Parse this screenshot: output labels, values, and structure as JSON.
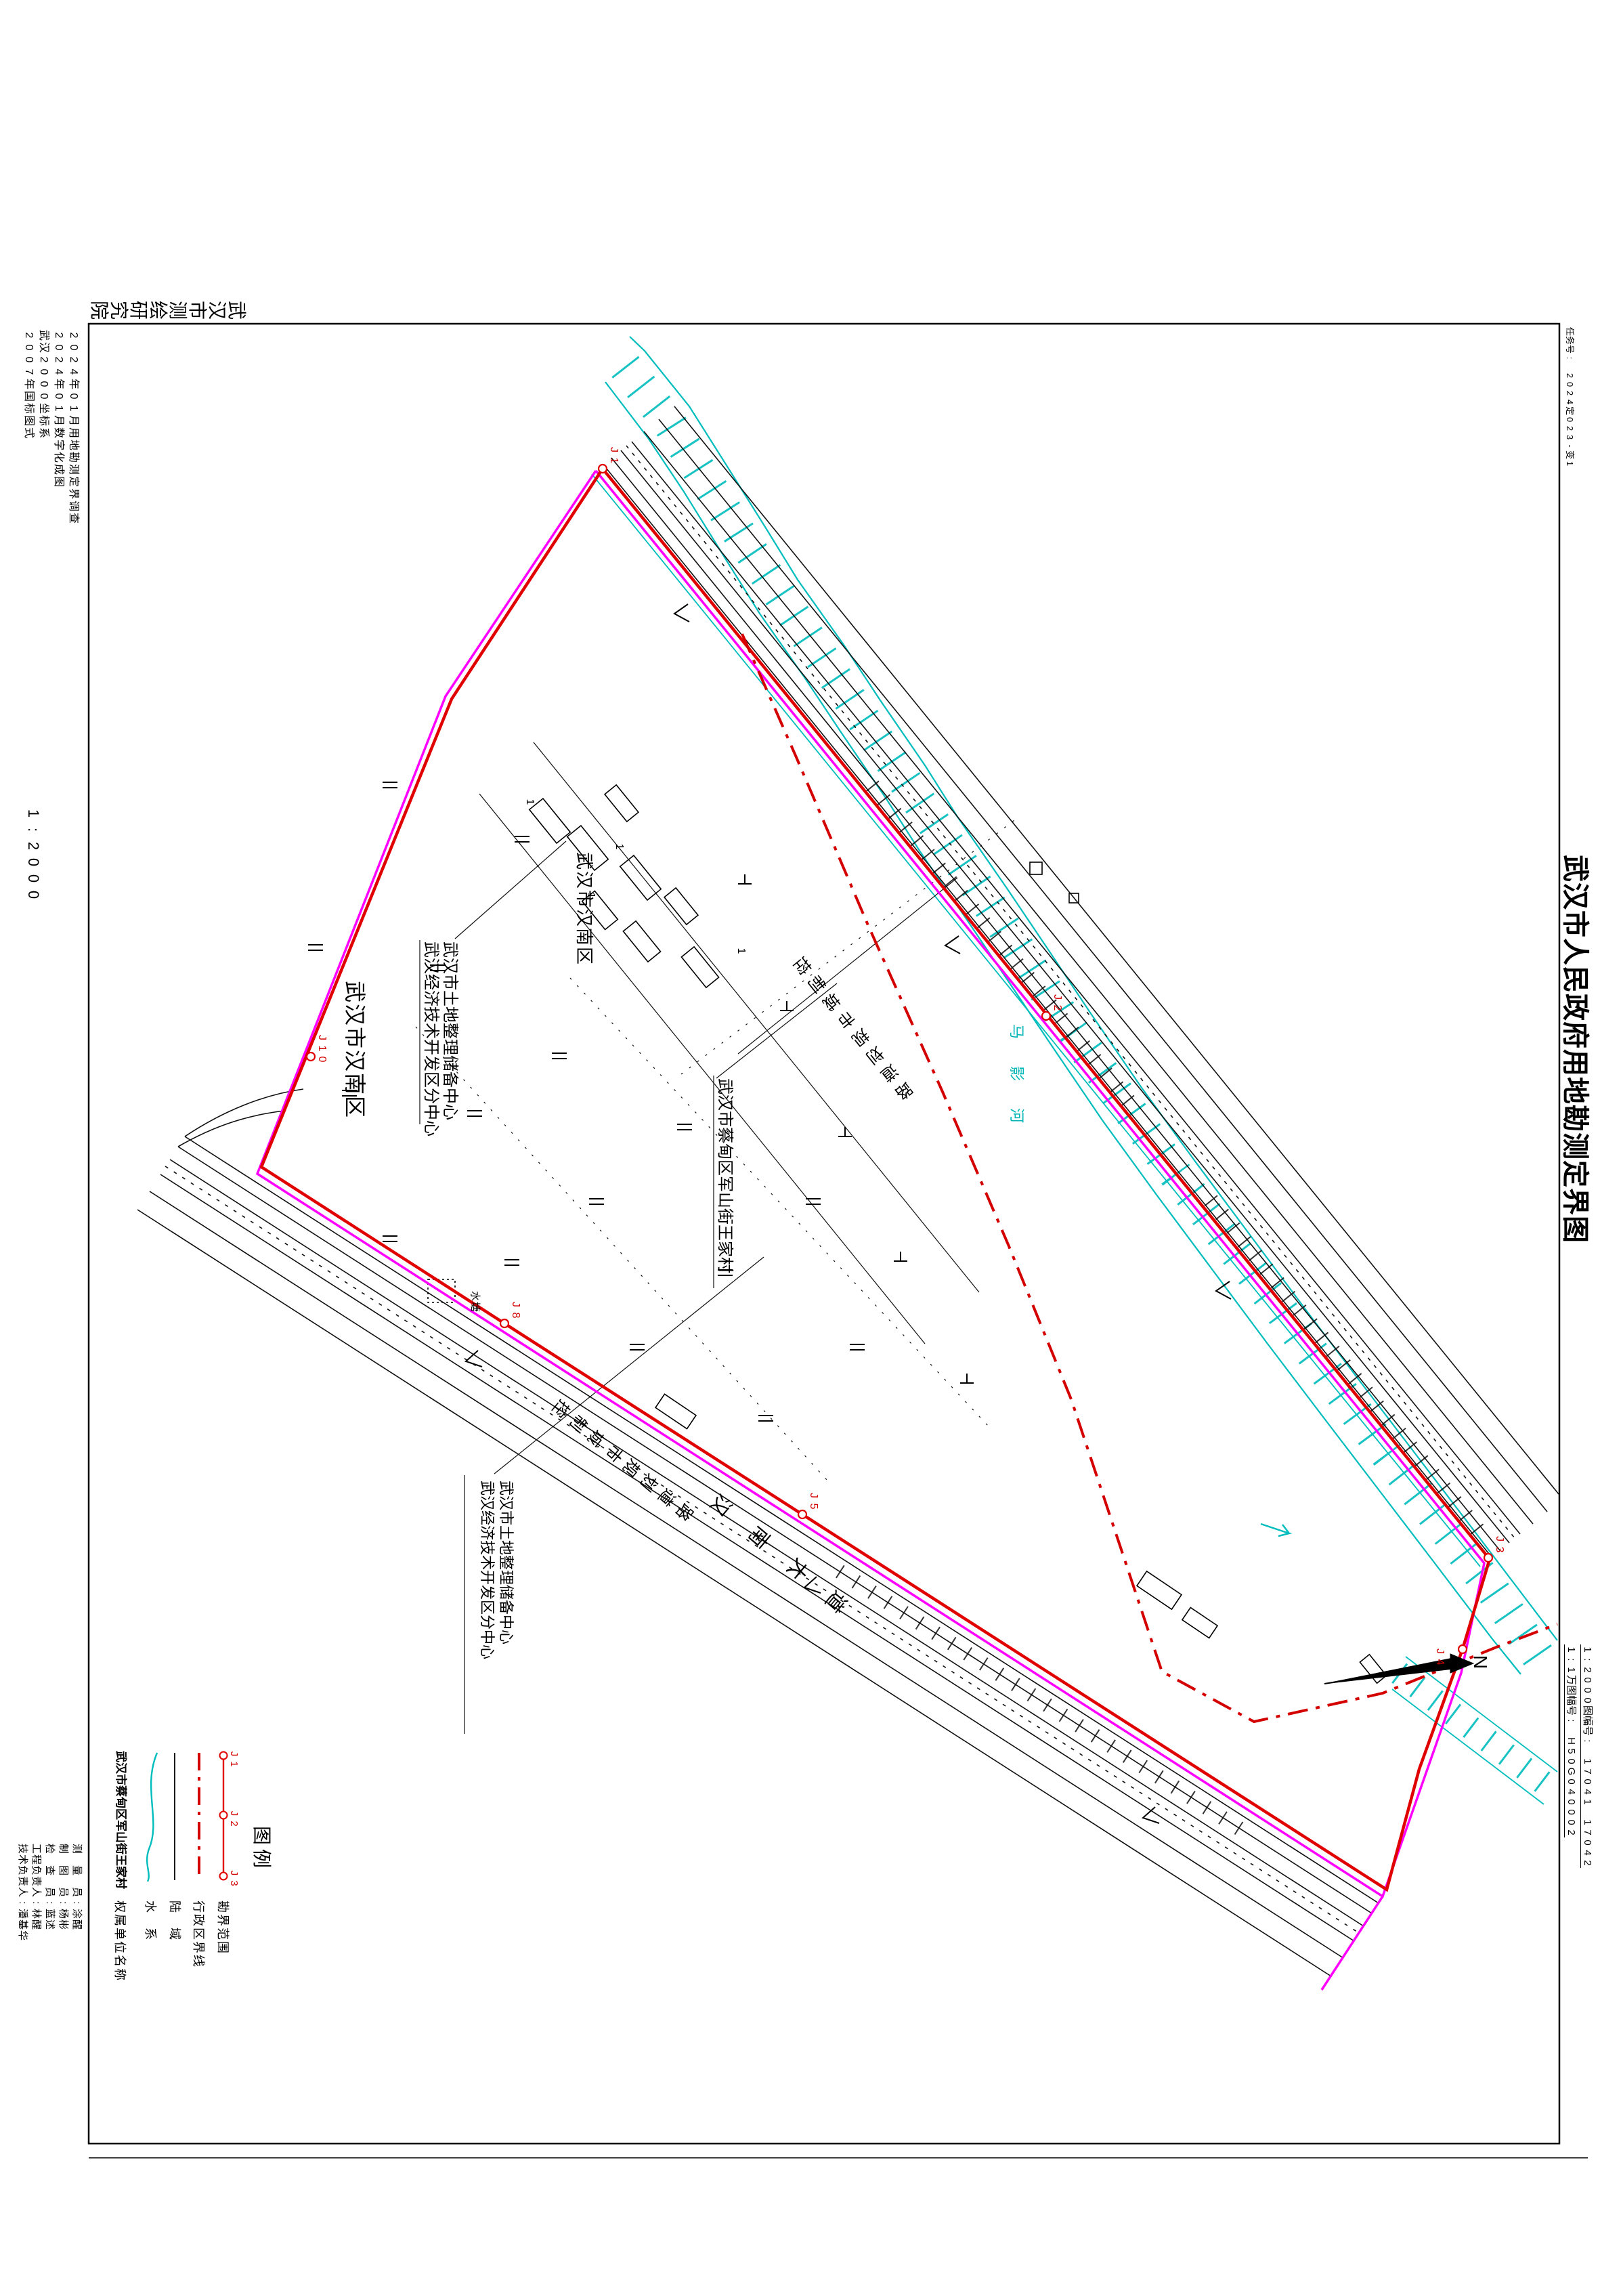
{
  "sheet": {
    "task_no": "任务号: 2024定023-变1",
    "title": "武汉市人民政府用地勘测定界图",
    "agency": "武汉市测绘研究院",
    "notes": [
      "2024年01月用地勘测定界调查",
      "2024年01月数字化成图",
      "武汉2000坐标系",
      "2007年国标图式"
    ],
    "scale": "1:2000",
    "sheet_no_2000": "1:2000图幅号: 17041 17042",
    "sheet_no_10000": "1:1万图幅号: H50G040002",
    "north_label": "N"
  },
  "legend": {
    "header": "图例",
    "boundary_points": [
      "J1",
      "J2",
      "J3"
    ],
    "items": [
      {
        "symbol": "red-line-with-points",
        "label": "勘界范围"
      },
      {
        "symbol": "red-dash-dot-line",
        "label": "行政区界线"
      },
      {
        "symbol": "black-line",
        "label": "陆 域"
      },
      {
        "symbol": "cyan-curve",
        "label": "水 系"
      },
      {
        "symbol": "name-example",
        "label": "权属单位名称",
        "example": "武汉市蔡甸区军山街王家村"
      }
    ]
  },
  "signatures": [
    "测 量 员:涂醒",
    "制 图 员:杨彬",
    "检 查 员:蓝述",
    "工程负责人:林醒",
    "技术负责人:潘基华"
  ],
  "map": {
    "labels": {
      "district_a": "武汉市汉南区",
      "district_b": "武汉市汉南区",
      "owner1_line1": "武汉市土地整理储备中心",
      "owner1_line2": "武汉经济技术开发区分中心",
      "owner2_line1": "武汉市土地整理储备中心",
      "owner2_line2": "武汉经济技术开发区分中心",
      "village": "武汉市蔡甸区军山街王家村",
      "planned_road_a": "控制城市规划道路",
      "planned_road_b": "控制城市规划道路",
      "avenue": "汉南大道",
      "river": "马影河",
      "pond": "水塘",
      "storey": "1"
    },
    "jpoints": [
      "J1",
      "J2",
      "J3",
      "J4",
      "J5",
      "J8",
      "J10"
    ],
    "colors": {
      "water": "#00b5b5",
      "survey_boundary": "#e10000",
      "admin_boundary": "#d40000",
      "cadastral_line": "#ff00ff"
    }
  }
}
